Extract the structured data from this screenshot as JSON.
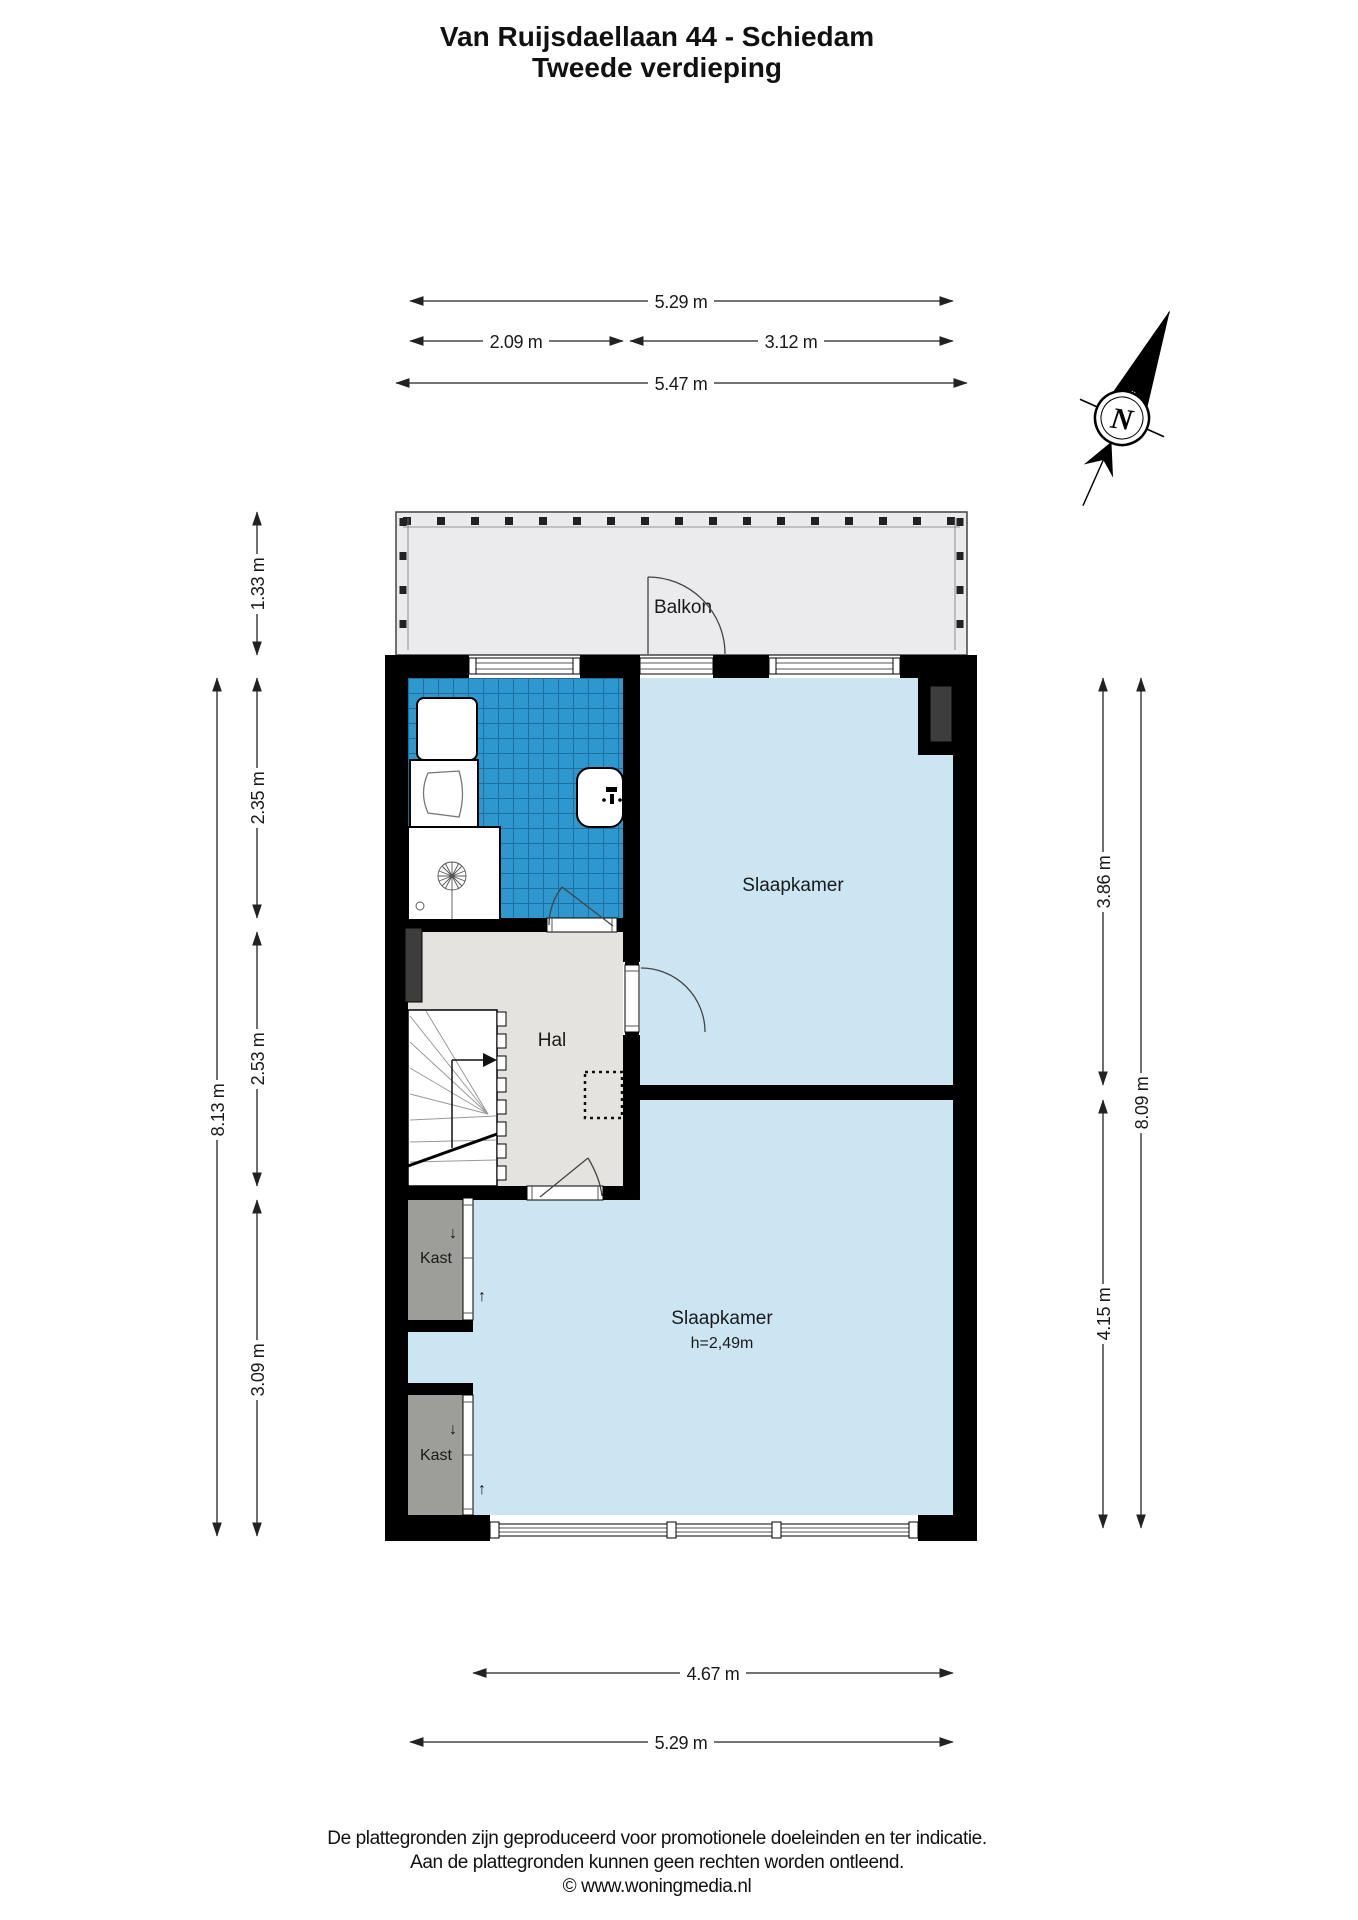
{
  "title": {
    "line1": "Van Ruijsdaellaan 44 - Schiedam",
    "line2": "Tweede verdieping"
  },
  "compass": {
    "north_label": "N"
  },
  "rooms": {
    "balkon": "Balkon",
    "slaapkamer_top": "Slaapkamer",
    "hal": "Hal",
    "slaapkamer_bottom": "Slaapkamer",
    "slaapkamer_bottom_ceiling_height": "h=2,49m",
    "kast_top": "Kast",
    "kast_bottom": "Kast"
  },
  "symbols": {
    "arrow_down": "↓",
    "arrow_up": "↑"
  },
  "dimensions": {
    "top_inner_total": "5.29 m",
    "top_bathroom": "2.09 m",
    "top_bedroom": "3.12 m",
    "top_outer": "5.47 m",
    "left_balcony": "1.33 m",
    "left_bathroom": "2.35 m",
    "left_hal": "2.53 m",
    "left_kast": "3.09 m",
    "left_total": "8.13 m",
    "right_bedroom_top": "3.86 m",
    "right_bedroom_bottom": "4.15 m",
    "right_total": "8.09 m",
    "bottom_bedroom": "4.67 m",
    "bottom_total": "5.29 m"
  },
  "footer": {
    "line1": "De plattegronden zijn geproduceerd voor promotionele doeleinden en ter indicatie.",
    "line2": "Aan de plattegronden kunnen geen rechten worden ontleend.",
    "line3": "© www.woningmedia.nl"
  },
  "colors": {
    "wall": "#000000",
    "bedroom_fill": "#cbe6f2",
    "hal_fill": "#e4e3df",
    "balcony_fill": "#ebebed",
    "kast_fill": "#9d9d9a",
    "tile_fill": "#2e97cd",
    "tile_grout": "#1d6f9f",
    "shaft_fill": "#3d3d3d"
  }
}
